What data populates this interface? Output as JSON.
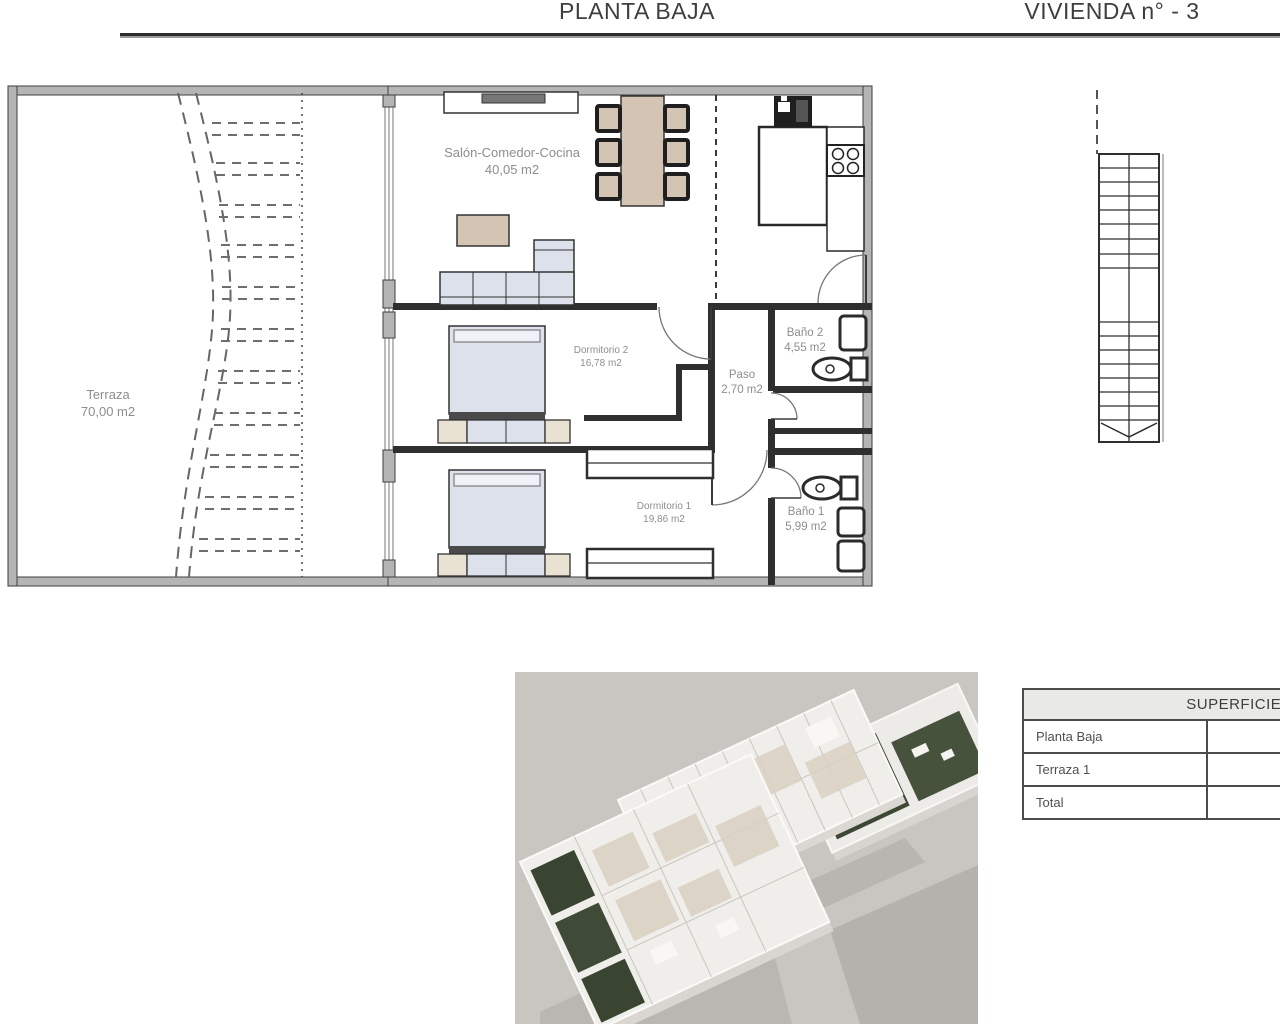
{
  "header": {
    "left_title": "PLANTA BAJA",
    "right_title": "VIVIENDA n° - 3"
  },
  "plan": {
    "terraza": {
      "name": "Terraza",
      "area": "70,00 m2"
    },
    "salon": {
      "name": "Salón-Comedor-Cocina",
      "area": "40,05 m2"
    },
    "dormitorio2": {
      "name": "Dormitorio 2",
      "area": "16,78 m2"
    },
    "paso": {
      "name": "Paso",
      "area": "2,70 m2"
    },
    "bano2": {
      "name": "Baño 2",
      "area": "4,55 m2"
    },
    "dormitorio1": {
      "name": "Dormitorio 1",
      "area": "19,86 m2"
    },
    "bano1": {
      "name": "Baño 1",
      "area": "5,99 m2"
    }
  },
  "surfaces_table": {
    "title": "SUPERFICIES",
    "rows": [
      {
        "label": "Planta Baja",
        "value": ""
      },
      {
        "label": "Terraza 1",
        "value": ""
      },
      {
        "label": "Total",
        "value": ""
      }
    ]
  },
  "colors": {
    "wall_dark": "#2f2f2f",
    "wall_gray": "#b5b5b5",
    "furniture_tan": "#d3c4b4",
    "furniture_blue": "#dce1eb",
    "label_gray": "#8e8e8e",
    "render_background": "#c8c6c1",
    "garden_green": "#3d4834",
    "table_header_bg": "#e9e9e7"
  }
}
